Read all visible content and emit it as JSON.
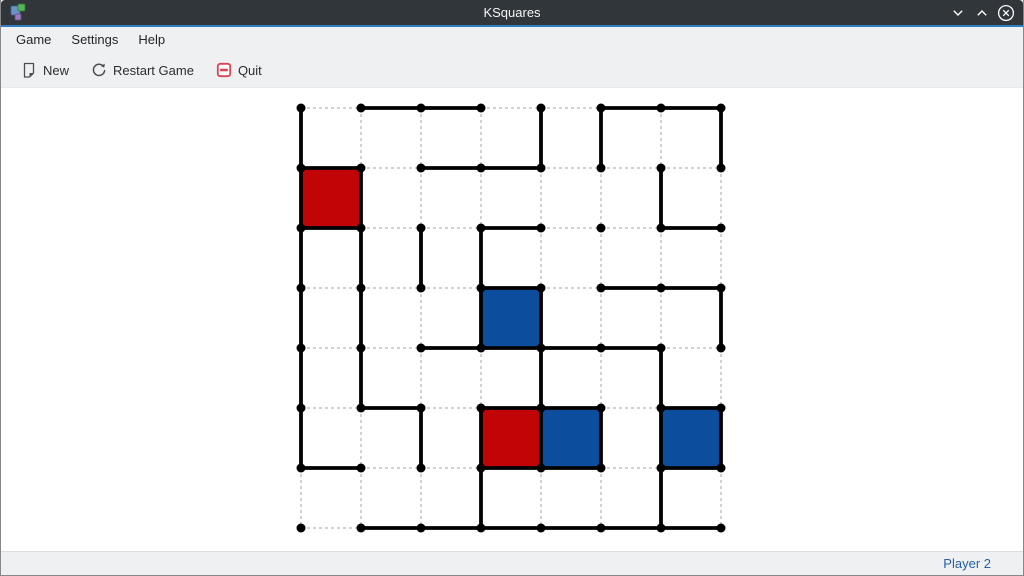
{
  "titlebar": {
    "title": "KSquares",
    "buttons": {
      "minimize": "chevron-down",
      "maximize": "chevron-up",
      "close": "circled-x"
    }
  },
  "menubar": {
    "items": [
      "Game",
      "Settings",
      "Help"
    ]
  },
  "toolbar": {
    "new_label": "New",
    "restart_label": "Restart Game",
    "quit_label": "Quit"
  },
  "statusbar": {
    "turn_label": "Player 2"
  },
  "colors": {
    "titlebar_bg": "#31363b",
    "accent_line": "#2d7dc0",
    "chrome_bg": "#eff0f1",
    "player1_red": "#c10406",
    "player2_blue": "#0d4d9e",
    "drawn_line": "#000000",
    "undrawn_line": "#b8b8b8",
    "dot": "#000000",
    "quit_icon_red": "#da4453",
    "status_text_blue": "#2660a4"
  },
  "board": {
    "dot_cols": 8,
    "dot_rows": 8,
    "origin_x": 300,
    "origin_y": 108,
    "spacing": 60,
    "dot_radius": 4.5,
    "drawn_line_width": 3.8,
    "horizontal_lines_drawn": [
      [
        1,
        0
      ],
      [
        2,
        0
      ],
      [
        5,
        0
      ],
      [
        6,
        0
      ],
      [
        0,
        1
      ],
      [
        2,
        1
      ],
      [
        3,
        1
      ],
      [
        0,
        2
      ],
      [
        3,
        2
      ],
      [
        6,
        2
      ],
      [
        3,
        3
      ],
      [
        5,
        3
      ],
      [
        6,
        3
      ],
      [
        2,
        4
      ],
      [
        3,
        4
      ],
      [
        4,
        4
      ],
      [
        5,
        4
      ],
      [
        1,
        5
      ],
      [
        3,
        5
      ],
      [
        4,
        5
      ],
      [
        6,
        5
      ],
      [
        0,
        6
      ],
      [
        3,
        6
      ],
      [
        4,
        6
      ],
      [
        6,
        6
      ],
      [
        1,
        7
      ],
      [
        2,
        7
      ],
      [
        3,
        7
      ],
      [
        4,
        7
      ],
      [
        5,
        7
      ],
      [
        6,
        7
      ]
    ],
    "vertical_lines_drawn": [
      [
        0,
        0
      ],
      [
        0,
        1
      ],
      [
        0,
        2
      ],
      [
        0,
        3
      ],
      [
        0,
        4
      ],
      [
        0,
        5
      ],
      [
        1,
        1
      ],
      [
        1,
        2
      ],
      [
        1,
        3
      ],
      [
        1,
        4
      ],
      [
        2,
        2
      ],
      [
        2,
        5
      ],
      [
        3,
        2
      ],
      [
        3,
        3
      ],
      [
        3,
        5
      ],
      [
        3,
        6
      ],
      [
        4,
        0
      ],
      [
        4,
        3
      ],
      [
        4,
        4
      ],
      [
        4,
        5
      ],
      [
        5,
        0
      ],
      [
        5,
        5
      ],
      [
        6,
        1
      ],
      [
        6,
        4
      ],
      [
        6,
        5
      ],
      [
        6,
        6
      ],
      [
        7,
        0
      ],
      [
        7,
        3
      ],
      [
        7,
        5
      ]
    ],
    "filled_squares": [
      {
        "col": 0,
        "row": 1,
        "player": 1
      },
      {
        "col": 3,
        "row": 3,
        "player": 2
      },
      {
        "col": 3,
        "row": 5,
        "player": 1
      },
      {
        "col": 4,
        "row": 5,
        "player": 2
      },
      {
        "col": 6,
        "row": 5,
        "player": 2
      }
    ]
  }
}
